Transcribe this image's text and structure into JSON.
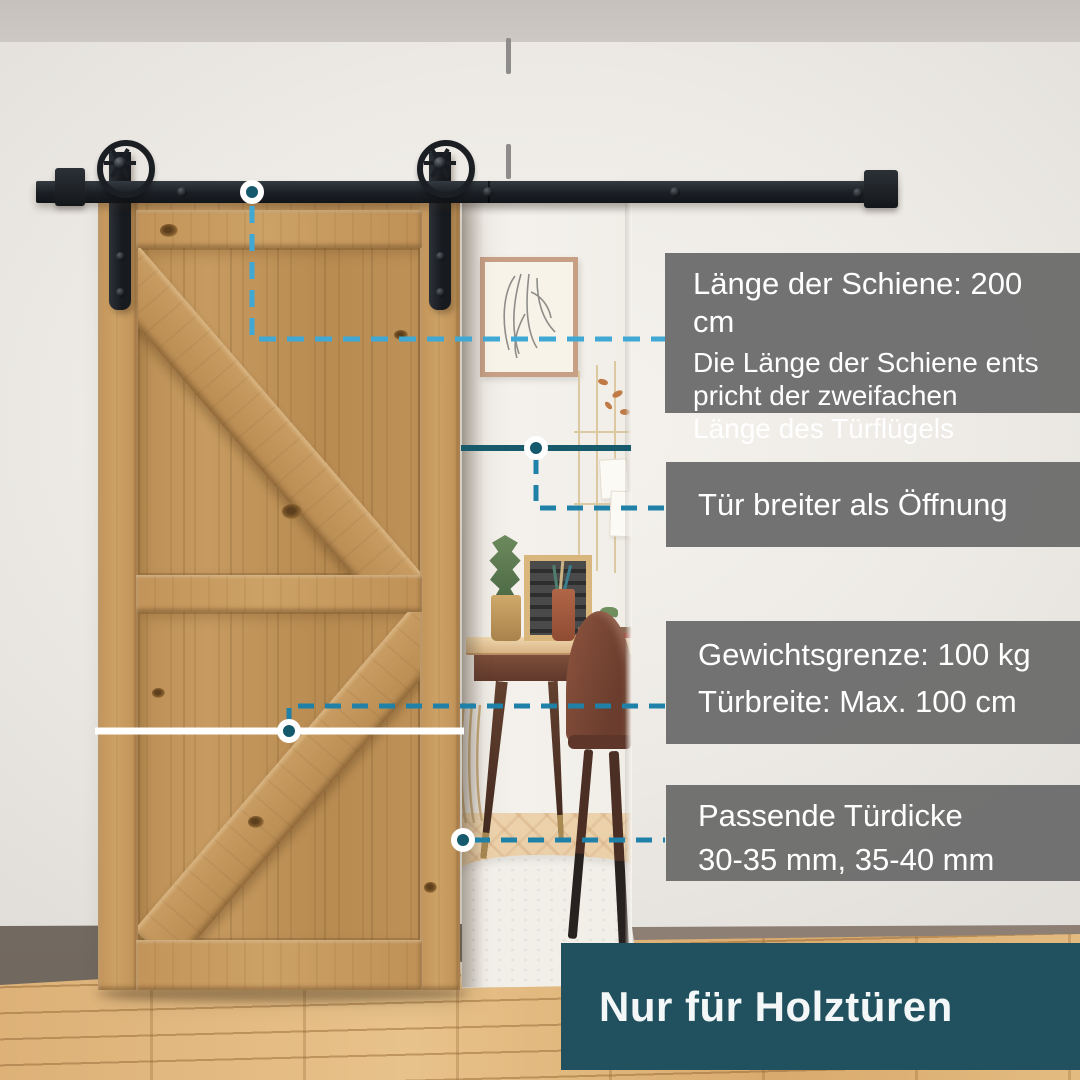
{
  "callout_rail_length": {
    "title": "Länge der Schiene: 200 cm",
    "line1": "Die Länge der Schiene ents",
    "line2": "pricht der zweifachen",
    "line3": "Länge des Türflügels"
  },
  "callout_door_wider": {
    "title": "Tür breiter als Öffnung"
  },
  "callout_weight": {
    "line1": "Gewichtsgrenze: 100 kg",
    "line2": "Türbreite: Max. 100 cm"
  },
  "callout_thickness": {
    "line1": "Passende Türdicke",
    "line2": "30-35 mm, 35-40 mm"
  },
  "banner": {
    "label": "Nur für Holztüren"
  },
  "colors": {
    "callout_box": "#6d6d6d",
    "banner_teal": "#21505f",
    "dash_light_blue": "#3fa8d4",
    "dash_teal_blue": "#1f81a8",
    "solid_teal_line": "#175a6c",
    "marker_dot": "#15596c",
    "hardware_black": "#1b1f24",
    "door_wood": "#bf9157"
  }
}
